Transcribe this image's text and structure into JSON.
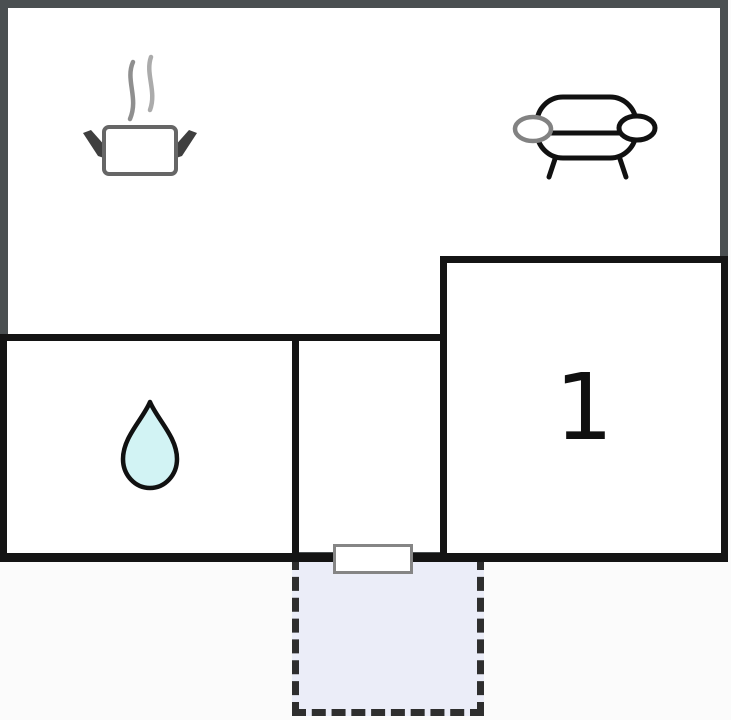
{
  "canvas": {
    "width": 731,
    "height": 720,
    "background": "#fbfbfb"
  },
  "floorplan": {
    "type": "vacation-home floor plan",
    "outer_wall_color": "#4a4f51",
    "inner_wall_color": "#141414",
    "room_fill": "#ffffff",
    "rooms": {
      "kitchen_living": {
        "name": "kitchen-living-area",
        "label": "",
        "icons": [
          "cooking-pot-icon",
          "sofa-icon"
        ]
      },
      "bathroom": {
        "name": "bathroom",
        "label": "",
        "icons": [
          "water-drop-icon"
        ]
      },
      "hallway": {
        "name": "hallway",
        "label": ""
      },
      "bedroom": {
        "name": "bedroom",
        "label": "1"
      },
      "terrace": {
        "name": "terrace",
        "fill": "#ebedf8",
        "border_color": "#2e2e2e",
        "border_style": "dashed"
      }
    },
    "door": {
      "name": "door-opening",
      "fill": "#ffffff",
      "border": "#858585"
    }
  },
  "icons": {
    "cooking_pot": {
      "meaning": "kitchen / stove",
      "stroke": "#666666",
      "handle_fill": "#3f3f3f",
      "steam_color": "#8f8f8f"
    },
    "sofa": {
      "meaning": "living room seating",
      "stroke": "#111111",
      "left_cushion_stroke": "#828282",
      "fill": "#ffffff"
    },
    "water_drop": {
      "meaning": "bathroom / water",
      "fill": "#d2f3f4",
      "stroke": "#111111"
    }
  }
}
